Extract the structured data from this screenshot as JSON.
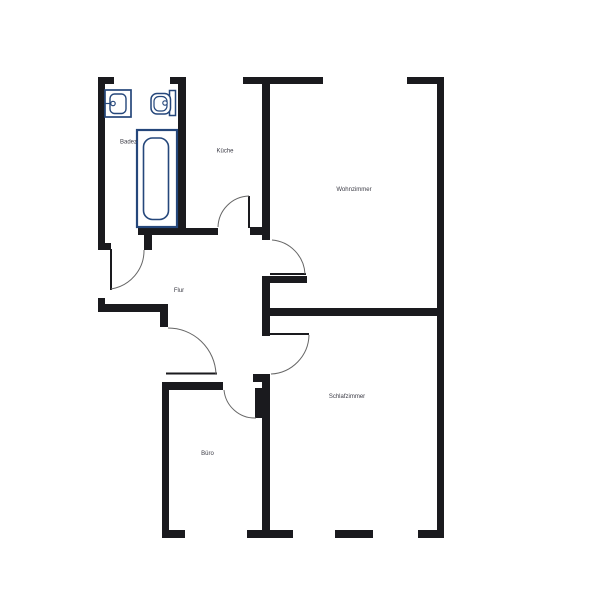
{
  "floorplan": {
    "title": "apartment-floorplan",
    "rooms": [
      {
        "id": "badezimmer",
        "name": "Badez"
      },
      {
        "id": "kueche",
        "name": "Küche"
      },
      {
        "id": "wohnzimmer",
        "name": "Wohnzimmer"
      },
      {
        "id": "flur",
        "name": "Flur"
      },
      {
        "id": "schlafzimmer",
        "name": "Schlafzimmer"
      },
      {
        "id": "buero",
        "name": "Büro"
      }
    ],
    "fixtures": [
      {
        "id": "sink",
        "icon": "sink-icon"
      },
      {
        "id": "toilet",
        "icon": "toilet-icon"
      },
      {
        "id": "bathtub",
        "icon": "bathtub-icon"
      }
    ],
    "door_count": "6",
    "colors": {
      "wall": "#1a1a1e",
      "fixture": "#25477b",
      "door_arc": "#666666",
      "label": "#3b3b45",
      "background": "#ffffff"
    }
  }
}
